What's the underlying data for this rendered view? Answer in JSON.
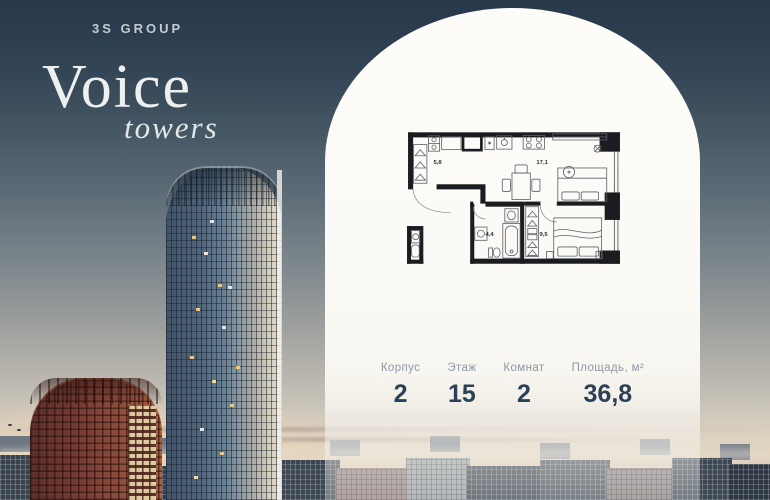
{
  "brand": {
    "group_label": "3S GROUP",
    "title": "Voice",
    "subtitle": "towers"
  },
  "floor_plan": {
    "rooms": [
      {
        "id": "hallway",
        "area": "5,8"
      },
      {
        "id": "living-kitchen",
        "area": "17,1"
      },
      {
        "id": "bathroom",
        "area": "4,4"
      },
      {
        "id": "bedroom",
        "area": "9,5"
      }
    ]
  },
  "stats": {
    "items": [
      {
        "label": "Корпус",
        "value": "2"
      },
      {
        "label": "Этаж",
        "value": "15"
      },
      {
        "label": "Комнат",
        "value": "2"
      },
      {
        "label": "Площадь, м²",
        "value": "36,8"
      }
    ]
  },
  "colors": {
    "value_navy": "#2c4156",
    "label_gray": "#8d97a4",
    "panel_white": "#fbfaf6",
    "sky_top": "#26384a"
  }
}
